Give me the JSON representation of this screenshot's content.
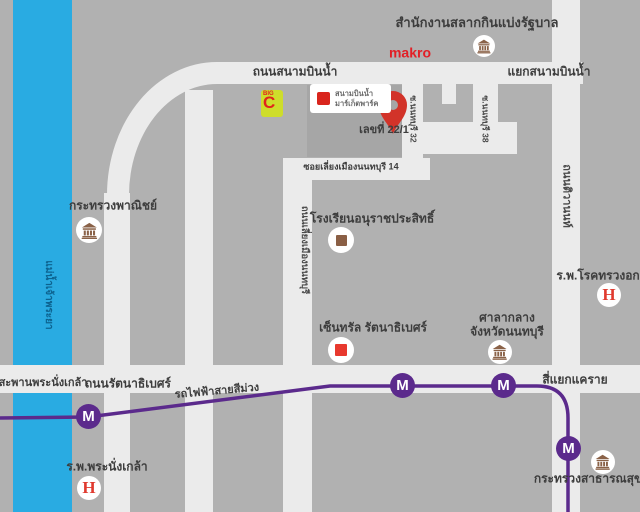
{
  "map": {
    "river": {
      "name": "แม่น้ำเจ้าพระยา",
      "color": "#29abe2"
    },
    "roads": {
      "sanambinnam": "ถนนสนามบินน้ำ",
      "sanambinnam_junction": "แยกสนามบินน้ำ",
      "soi_nonthaburi_32": "ซ.นนทบุรี 32",
      "soi_nonthaburi_38": "ซ.นนทบุรี 38",
      "soi_liang_mueang_14": "ซอยเลี่ยงเมืองนนทบุรี 14",
      "liang_mueang": "ถนนเลี่ยงเมืองนนทบุรี",
      "tiwanon": "ถนนติวานนท์",
      "rattanathibet": "ถนนรัตนาธิเบศร์",
      "pranangklao_bridge": "สะพานพระนั่งเกล้า",
      "khae_rai_junction": "สี่แยกแคราย"
    },
    "transit": {
      "purple_line_label": "รถไฟฟ้าสายสีม่วง",
      "station_symbol": "M",
      "line_color": "#5b2a8c"
    },
    "places": {
      "lottery_office": "สำนักงานสลากกินแบ่งรัฐบาล",
      "makro": "makro",
      "big_c_top": "BIG",
      "big_c_letter": "C",
      "market_park_line1": "สนามบินน้ำ",
      "market_park_line2": "มาร์เก็ตพาร์ค",
      "destination_address": "เลขที่ 22/1",
      "school": "โรงเรียนอนุราชประสิทธิ์",
      "ministry_commerce": "กระทรวงพาณิชย์",
      "central_rattanathibet": "เซ็นทรัล รัตนาธิเบศร์",
      "city_hall_line1": "ศาลากลาง",
      "city_hall_line2": "จังหวัดนนทบุรี",
      "chest_hospital": "ร.พ.โรคทรวงอก",
      "pranangklao_hospital": "ร.พ.พระนั่งเกล้า",
      "ministry_public_health": "กระทรวงสาธารณสุข",
      "hospital_symbol": "H",
      "accent_red": "#d9251d"
    }
  }
}
